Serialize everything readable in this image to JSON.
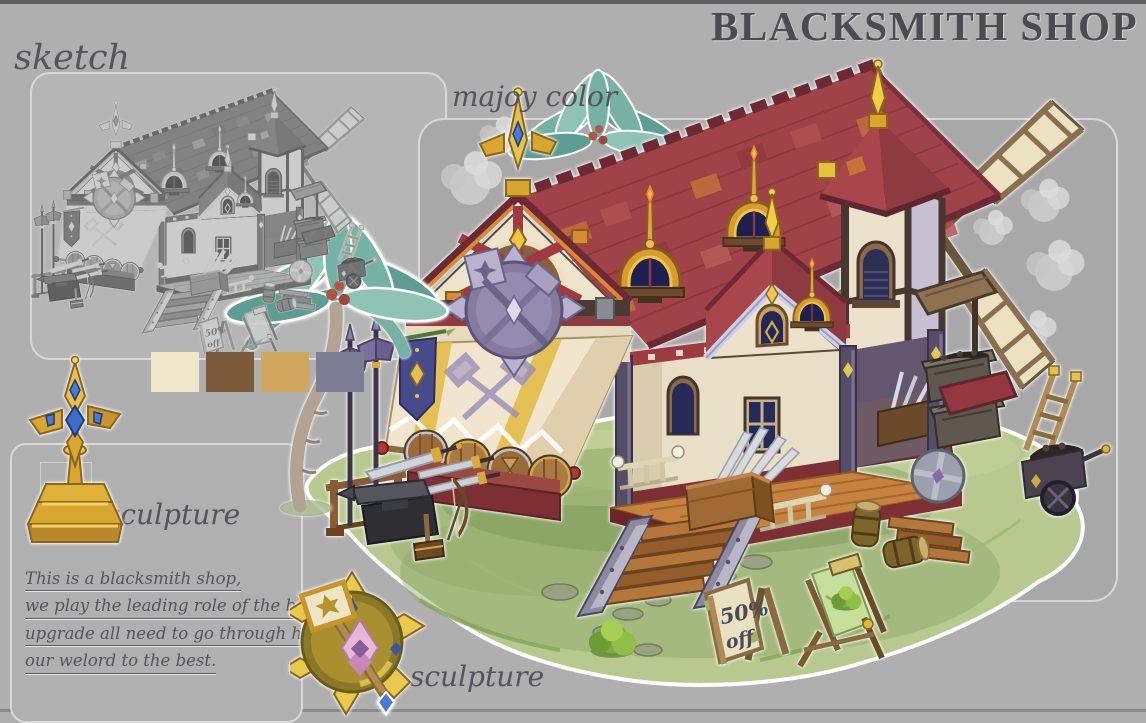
{
  "title": "BLACKSMITH SHOP",
  "labels": {
    "sketch": "sketch",
    "major_color": "majoy color",
    "sculpture_left": "sculpture",
    "sculpture_bottom": "sculpture"
  },
  "palette": {
    "swatches": [
      {
        "name": "cream",
        "hex": "#efe8cb"
      },
      {
        "name": "brown",
        "hex": "#7b5b39"
      },
      {
        "name": "tan",
        "hex": "#d1a75f"
      },
      {
        "name": "blue-gray",
        "hex": "#7f7d96"
      }
    ]
  },
  "description": {
    "lines": [
      "This is a blacksmith shop,",
      "we play the leading role of the blame to",
      "upgrade all need to go through here.leding",
      "our welord to the best."
    ]
  },
  "sign": {
    "line1": "50%",
    "line2": "off"
  }
}
